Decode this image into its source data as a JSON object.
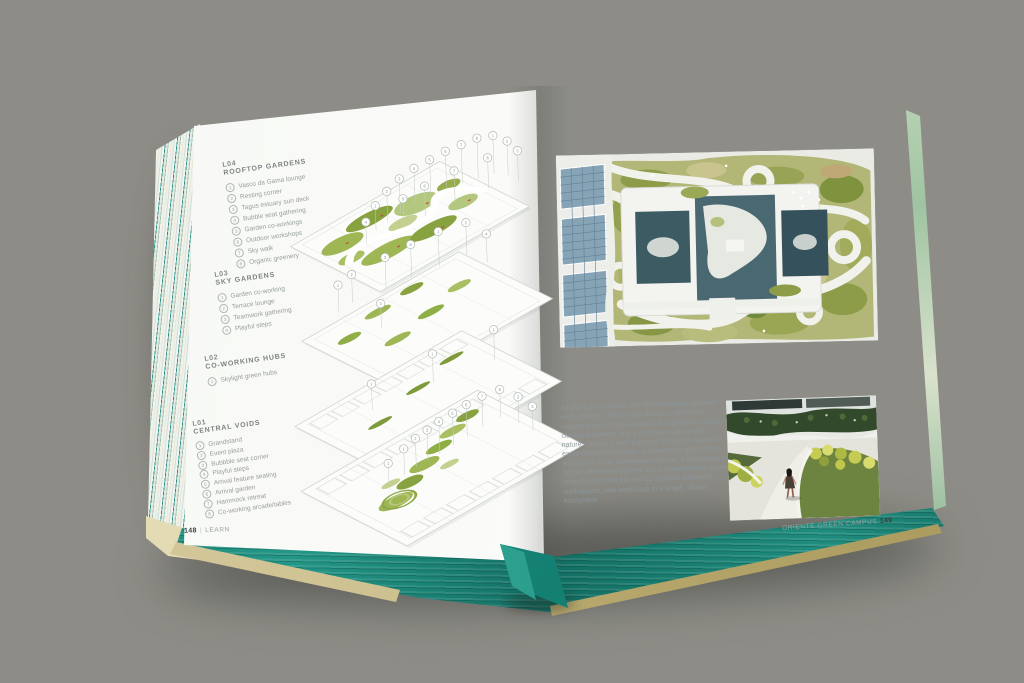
{
  "book": {
    "left_page": {
      "levels": [
        {
          "id": "L04",
          "title": "ROOFTOP GARDENS",
          "items": [
            "Vasco da Gama lounge",
            "Resting corner",
            "Tagus estuary sun deck",
            "Bubble seat gathering",
            "Garden co-workings",
            "Outdoor workshops",
            "Sky walk",
            "Organic greenery"
          ]
        },
        {
          "id": "L03",
          "title": "SKY GARDENS",
          "items": [
            "Garden co-working",
            "Terrace lounge",
            "Teamwork gathering",
            "Playful steps"
          ]
        },
        {
          "id": "L02",
          "title": "CO-WORKING HUBS",
          "items": [
            "Skylight green hubs"
          ]
        },
        {
          "id": "L01",
          "title": "CENTRAL VOIDS",
          "items": [
            "Grandstand",
            "Event plaza",
            "Bubbble seat corner",
            "Playful steps",
            "Arrival feature seating",
            "Arrival garden",
            "Hammock retreat",
            "Co-working arcade/tables"
          ]
        }
      ],
      "footer": {
        "page": "148",
        "divider": "|",
        "section": "LEARN"
      }
    },
    "right_page": {
      "paragraph": "As cities grow denser and the boundaries between work, leisure, and learning dissolve, new urban models must emerge—models that prioritize people, climate resilience, and a healthier balance with nature. Oriente Green Campus, located in Lisbon's eastern business district, is a landmark project that addresses these challenges head-on. It transforms a former office development into a contemporary, green infrastructure hub that brings together education, workspaces, and landscape in a single, vibrant ecosystem.",
      "footer": {
        "title": "ORIENTE GREEN CAMPUS",
        "page": "149"
      }
    },
    "colors": {
      "edge_teal": "#1b8577",
      "ribbon_teal": "#17897b",
      "cover_khaki": "#c9bc8b",
      "diagram_green": "#8fae45",
      "page_white": "#f8f9f6",
      "backdrop_gray": "#a09f98"
    }
  }
}
